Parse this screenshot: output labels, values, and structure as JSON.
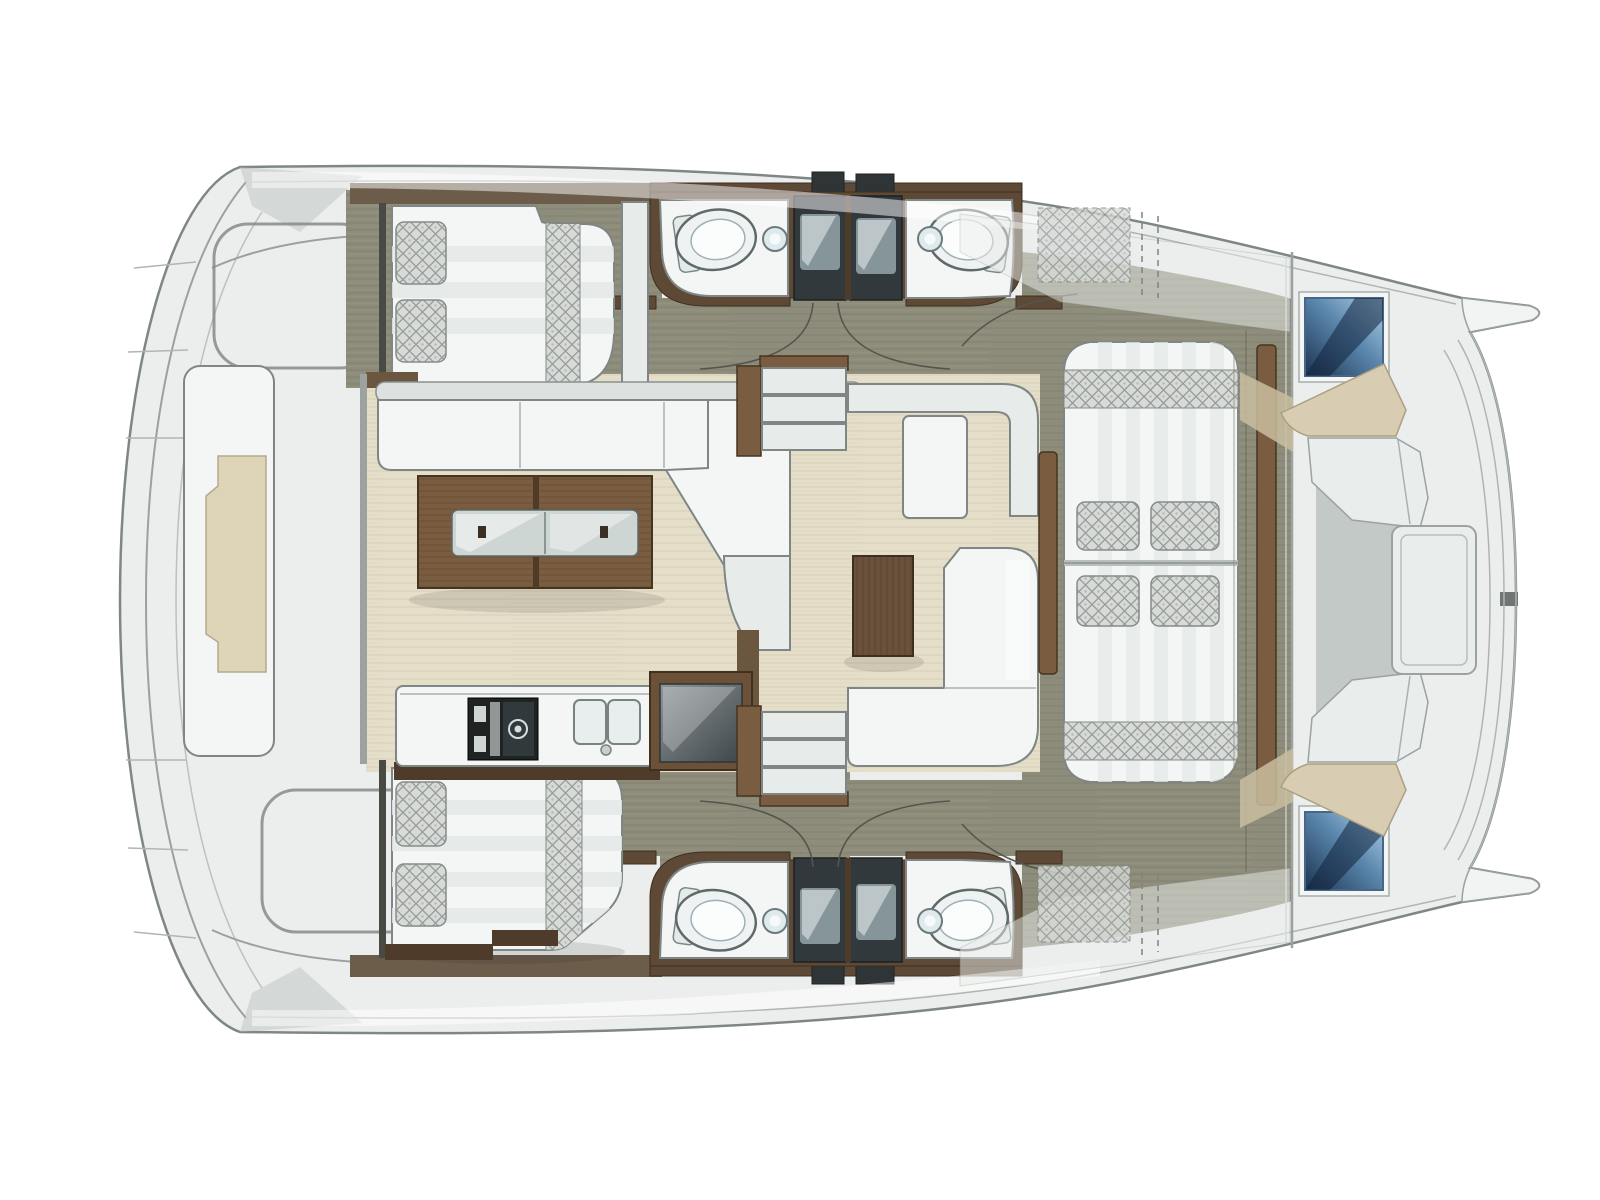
{
  "meta": {
    "title": "Catamaran floor plan — top-down interior layout, bow to the right",
    "diagram_type": "boat-floorplan",
    "orientation": "bow-right"
  },
  "palette": {
    "hull": "#eceeed",
    "outline": "#7e8785",
    "deck": "#8e8c7b",
    "deck_line": "#81806f",
    "floor": "#e5dfc9",
    "floor_line": "#d9d2bb",
    "wood": "#7a5d41",
    "wood_dark": "#4e3b2a",
    "wood_dark2": "#46341f",
    "wood_mid": "#6b5138",
    "wall_brown": "#5d4936",
    "white": "#f4f6f5",
    "white_dim": "#e7ebe9",
    "fabric": "#d7dad7",
    "fabric_line": "#979d9a",
    "shower": "#32393c",
    "shower_inner": "#8fa0a4",
    "hatch_light": "#b3d2e8",
    "hatch_mid": "#5b87ad",
    "hatch_dark": "#1c3350",
    "tan": "#d8cdb2",
    "tan_dark": "#ac9f80",
    "platform_tan": "#ded4b8",
    "glass": "#cdd6d3"
  },
  "elements": [
    {
      "name": "hull-outline",
      "kind": "structure"
    },
    {
      "name": "stern-platform",
      "kind": "structure"
    },
    {
      "name": "aft-cabin-bed-starboard",
      "kind": "furniture"
    },
    {
      "name": "aft-cabin-bed-port",
      "kind": "furniture"
    },
    {
      "name": "head-starboard",
      "kind": "room",
      "fixtures": [
        "toilet",
        "sink",
        "shower"
      ]
    },
    {
      "name": "head-starboard-2",
      "kind": "room",
      "fixtures": [
        "toilet",
        "sink",
        "shower"
      ]
    },
    {
      "name": "head-port",
      "kind": "room",
      "fixtures": [
        "toilet",
        "sink",
        "shower"
      ]
    },
    {
      "name": "head-port-2",
      "kind": "room",
      "fixtures": [
        "toilet",
        "sink",
        "shower"
      ]
    },
    {
      "name": "salon-sofa",
      "kind": "furniture"
    },
    {
      "name": "salon-table",
      "kind": "furniture"
    },
    {
      "name": "galley-counter",
      "kind": "furniture",
      "fixtures": [
        "stove",
        "double-sink",
        "fridge"
      ]
    },
    {
      "name": "companionway-steps-starboard",
      "kind": "structure"
    },
    {
      "name": "companionway-steps-port",
      "kind": "structure"
    },
    {
      "name": "cockpit-bench",
      "kind": "furniture"
    },
    {
      "name": "cockpit-chaise",
      "kind": "furniture"
    },
    {
      "name": "cockpit-coffee-table",
      "kind": "furniture"
    },
    {
      "name": "cockpit-corner-sofa",
      "kind": "furniture"
    },
    {
      "name": "forward-sunbed",
      "kind": "furniture",
      "cushions": 4
    },
    {
      "name": "forward-cockpit-seating",
      "kind": "furniture"
    },
    {
      "name": "bow-hatch-starboard",
      "kind": "fixture"
    },
    {
      "name": "bow-hatch-port",
      "kind": "fixture"
    },
    {
      "name": "door-swing-arcs",
      "kind": "annotation",
      "count": 8
    }
  ]
}
